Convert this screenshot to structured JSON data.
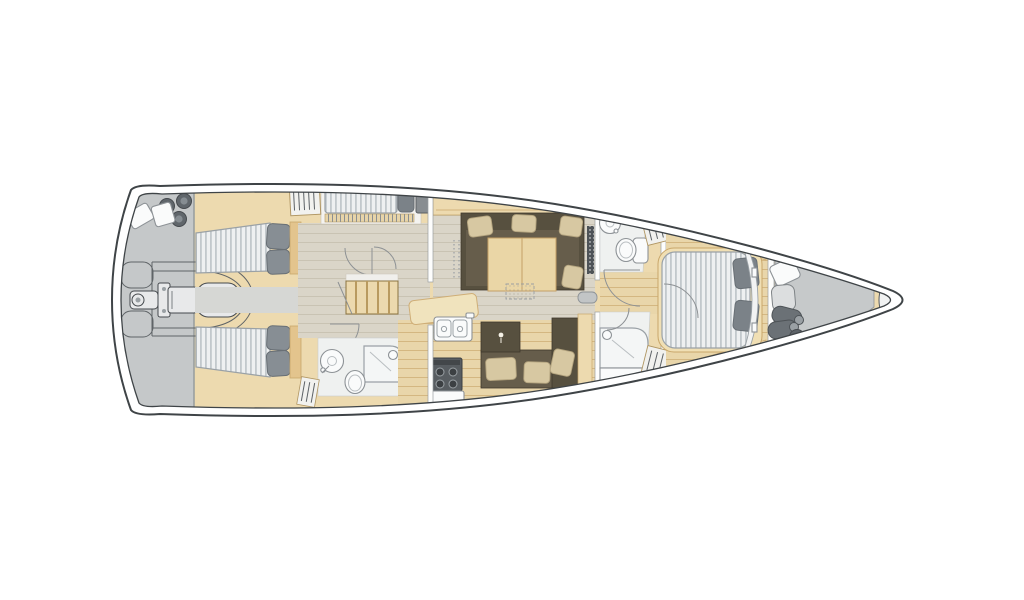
{
  "title": "Sailing yacht interior floor plan, top view, bow pointing right",
  "vessel": {
    "view": "top-down deck plan",
    "bow_direction": "right",
    "stern_direction": "left",
    "cabins_visible": 4,
    "double_berths": 3,
    "single_berths": 1,
    "bathrooms_visible": 3
  },
  "areas": [
    {
      "id": "stern-garage",
      "label": "Stern garage / technical area with stowed tender and outboard engine"
    },
    {
      "id": "stern-fenders",
      "label": "Three round fenders and two stowed boxes"
    },
    {
      "id": "aft-cabin-top",
      "label": "Aft double cabin (top) with striped mattress and two pillows"
    },
    {
      "id": "aft-cabin-bottom",
      "label": "Aft double cabin (bottom) with striped mattress and two pillows"
    },
    {
      "id": "skipper-cabin",
      "label": "Single berth cabin with pillow and hanging locker"
    },
    {
      "id": "companionway",
      "label": "Companionway stairs, five treads"
    },
    {
      "id": "aft-head",
      "label": "Aft bathroom with round basin, toilet and shower tray"
    },
    {
      "id": "salon",
      "label": "Salon with U-shaped sofa, four cushions, dining table and folding stool"
    },
    {
      "id": "lounge-sofa",
      "label": "Lounge sofa with three cushions"
    },
    {
      "id": "galley",
      "label": "Galley with twin-bowl sink island and four-burner stove"
    },
    {
      "id": "day-head",
      "label": "Forward day head with round basin and toilet"
    },
    {
      "id": "shower-room",
      "label": "Forward shower room with shower enclosure"
    },
    {
      "id": "wardrobes",
      "label": "Hanging lockers with clothes-hanger symbols"
    },
    {
      "id": "owner-cabin",
      "label": "Owner cabin with island double bed, two pillows and curved headboard"
    },
    {
      "id": "sail-locker",
      "label": "Forepeak sail locker with bags and fenders"
    },
    {
      "id": "bow-fitting",
      "label": "Bow anchor fitting"
    }
  ],
  "icons": [
    "fender-icon",
    "outboard-engine-icon",
    "tender-icon",
    "hanger-icon",
    "sink-icon",
    "toilet-icon",
    "shower-icon",
    "stove-icon",
    "door-swing-icon",
    "stairs-icon",
    "table-icon",
    "cushion-icon"
  ],
  "palette": {
    "hullOutline": "#3f4447",
    "garageGray": "#c5c8c9",
    "forepeakGray": "#c6c9ca",
    "woodBeige": "#eddaaf",
    "woodTrim": "#c9a76b",
    "woodTable": "#ead6a6",
    "floorLight": "#dad5c8",
    "floorWarm": "#e9d6aa",
    "mattressBase": "#eef0f1",
    "mattressStripe": "#c2c8cc",
    "mattressEdge": "#9aa1a6",
    "pillowGray": "#878e94",
    "pillowDark": "#7b8288",
    "pillowEdge": "#686f75",
    "sofaDark": "#57503f",
    "sofaSeat": "#665d4b",
    "sofaPillow": "#d7c8a2",
    "bathFloor": "#eff1f0",
    "fixtureWhite": "#fafbfb",
    "fixtureLine": "#8d9296",
    "wallWhite": "#fdfdfc",
    "wallLine": "#9b9fa2",
    "doorArc": "#8d9194",
    "gearDark": "#45494d",
    "gearDarkFill": "#60666b",
    "gearMid": "#e8e9ea",
    "grilleDark": "#4e5357"
  }
}
